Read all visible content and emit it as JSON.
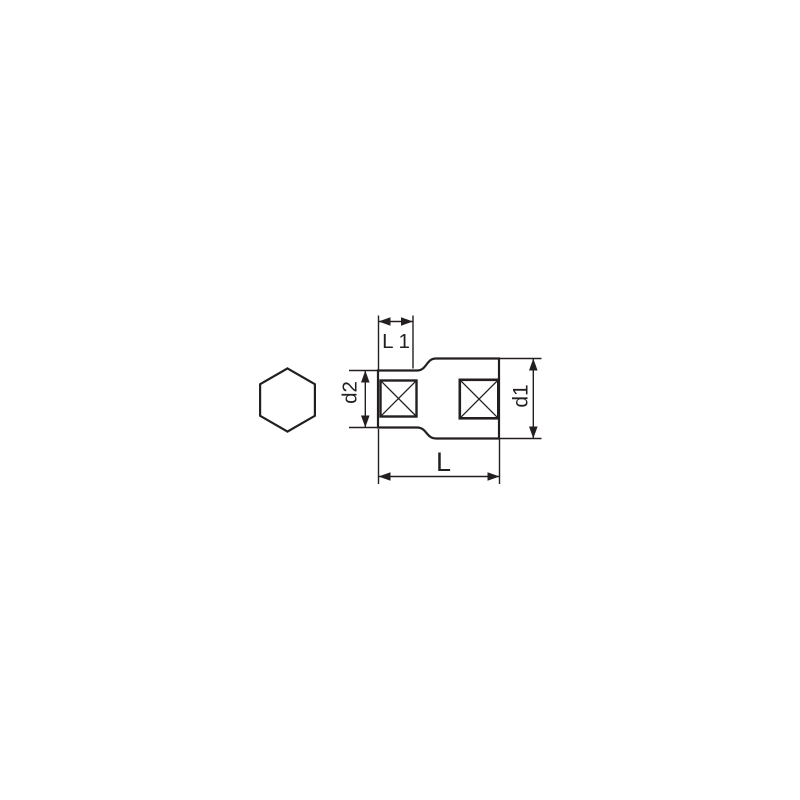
{
  "diagram": {
    "title": "socket-technical-dimension-drawing",
    "labels": {
      "l1": "L 1",
      "d2": "d2",
      "d1": "d1",
      "l": "L"
    },
    "colors": {
      "line": "#231f20",
      "background": "#ffffff"
    }
  }
}
